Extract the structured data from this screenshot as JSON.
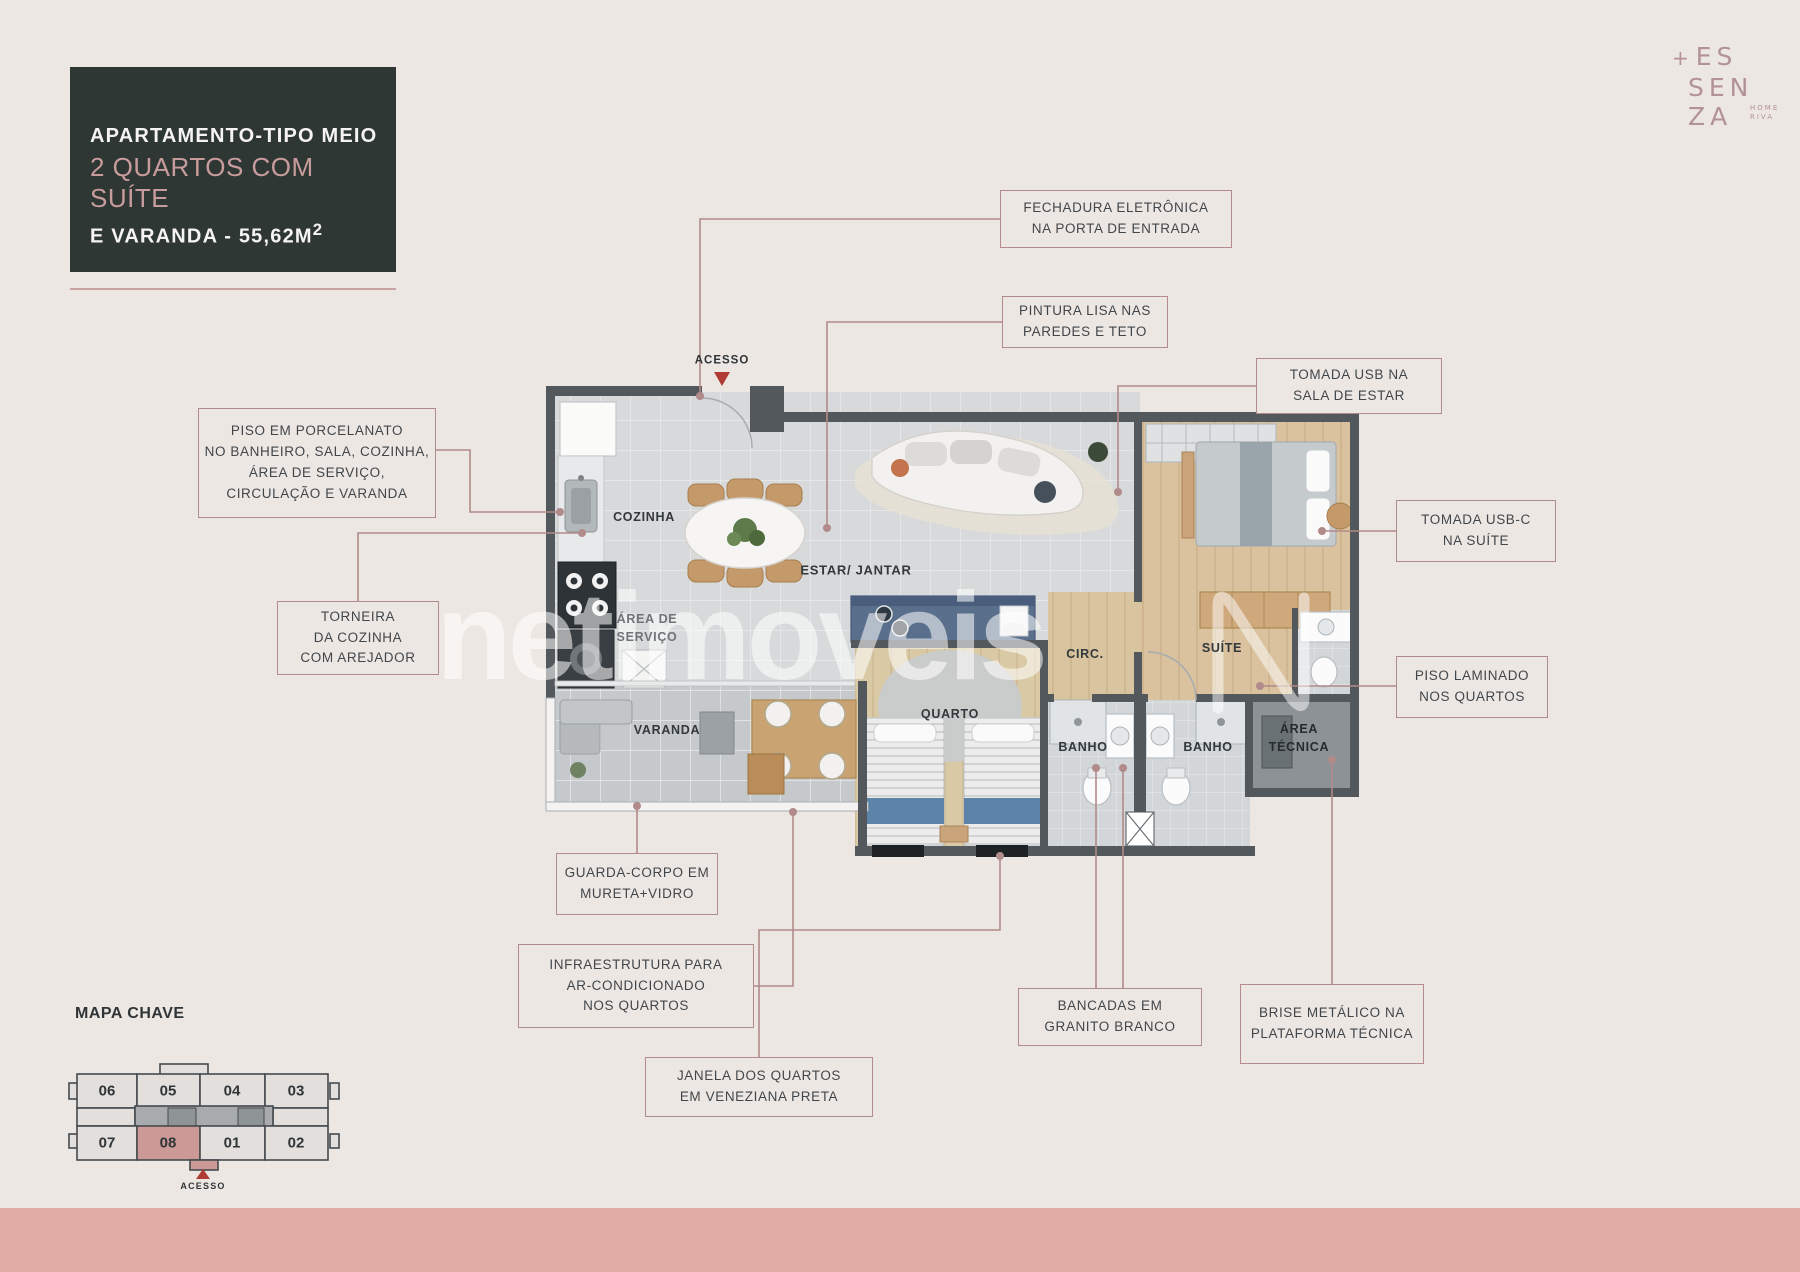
{
  "colors": {
    "page_bg": "#EDE7E3",
    "panel_dark": "#2E3734",
    "title_rose": "#C89C9C",
    "callout_border": "#B18A8A",
    "marker_red": "#AF3B34",
    "footer_band": "#E0ACA5",
    "highlight_unit": "#CC9A96"
  },
  "title_block": {
    "line1": "APARTAMENTO-TIPO MEIO",
    "line2": "2 QUARTOS COM SUÍTE",
    "line3": "E VARANDA - 55,62M",
    "area_sup": "2"
  },
  "logo": {
    "plus": "+",
    "line1": "ES",
    "line2": "SEN",
    "line3": "ZA",
    "sub1": "HOME",
    "sub2": "RIVA"
  },
  "watermark": {
    "text": "netimoveis"
  },
  "plan": {
    "rooms": {
      "acesso": "ACESSO",
      "cozinha": "COZINHA",
      "area_servico_1": "ÁREA DE",
      "area_servico_2": "SERVIÇO",
      "estar": "ESTAR/ JANTAR",
      "varanda": "VARANDA",
      "quarto": "QUARTO",
      "circ": "CIRC.",
      "suite": "SUÍTE",
      "banho1": "BANHO",
      "banho2": "BANHO",
      "tecnica_1": "ÁREA",
      "tecnica_2": "TÉCNICA"
    }
  },
  "callouts": {
    "fechadura": {
      "l1": "FECHADURA ELETRÔNICA",
      "l2": "NA PORTA DE ENTRADA"
    },
    "pintura": {
      "l1": "PINTURA LISA NAS",
      "l2": "PAREDES E TETO"
    },
    "usb_sala": {
      "l1": "TOMADA USB NA",
      "l2": "SALA DE ESTAR"
    },
    "usbc_suite": {
      "l1": "TOMADA USB-C",
      "l2": "NA SUÍTE"
    },
    "porcelanato": {
      "l1": "PISO EM PORCELANATO",
      "l2": "NO BANHEIRO, SALA, COZINHA,",
      "l3": "ÁREA DE SERVIÇO,",
      "l4": "CIRCULAÇÃO E VARANDA"
    },
    "torneira": {
      "l1": "TORNEIRA",
      "l2": "DA COZINHA",
      "l3": "COM AREJADOR"
    },
    "laminado": {
      "l1": "PISO LAMINADO",
      "l2": "NOS QUARTOS"
    },
    "guarda": {
      "l1": "GUARDA-CORPO EM",
      "l2": "MURETA+VIDRO"
    },
    "infra": {
      "l1": "INFRAESTRUTURA PARA",
      "l2": "AR-CONDICIONADO",
      "l3": "NOS QUARTOS"
    },
    "janela": {
      "l1": "JANELA DOS QUARTOS",
      "l2": "EM VENEZIANA PRETA"
    },
    "bancadas": {
      "l1": "BANCADAS EM",
      "l2": "GRANITO BRANCO"
    },
    "brise": {
      "l1": "BRISE METÁLICO NA",
      "l2": "PLATAFORMA TÉCNICA"
    }
  },
  "mapa_chave": {
    "title": "MAPA CHAVE",
    "units": [
      "06",
      "05",
      "04",
      "03",
      "07",
      "08",
      "01",
      "02"
    ],
    "highlighted_unit": "08",
    "acesso": "ACESSO"
  }
}
